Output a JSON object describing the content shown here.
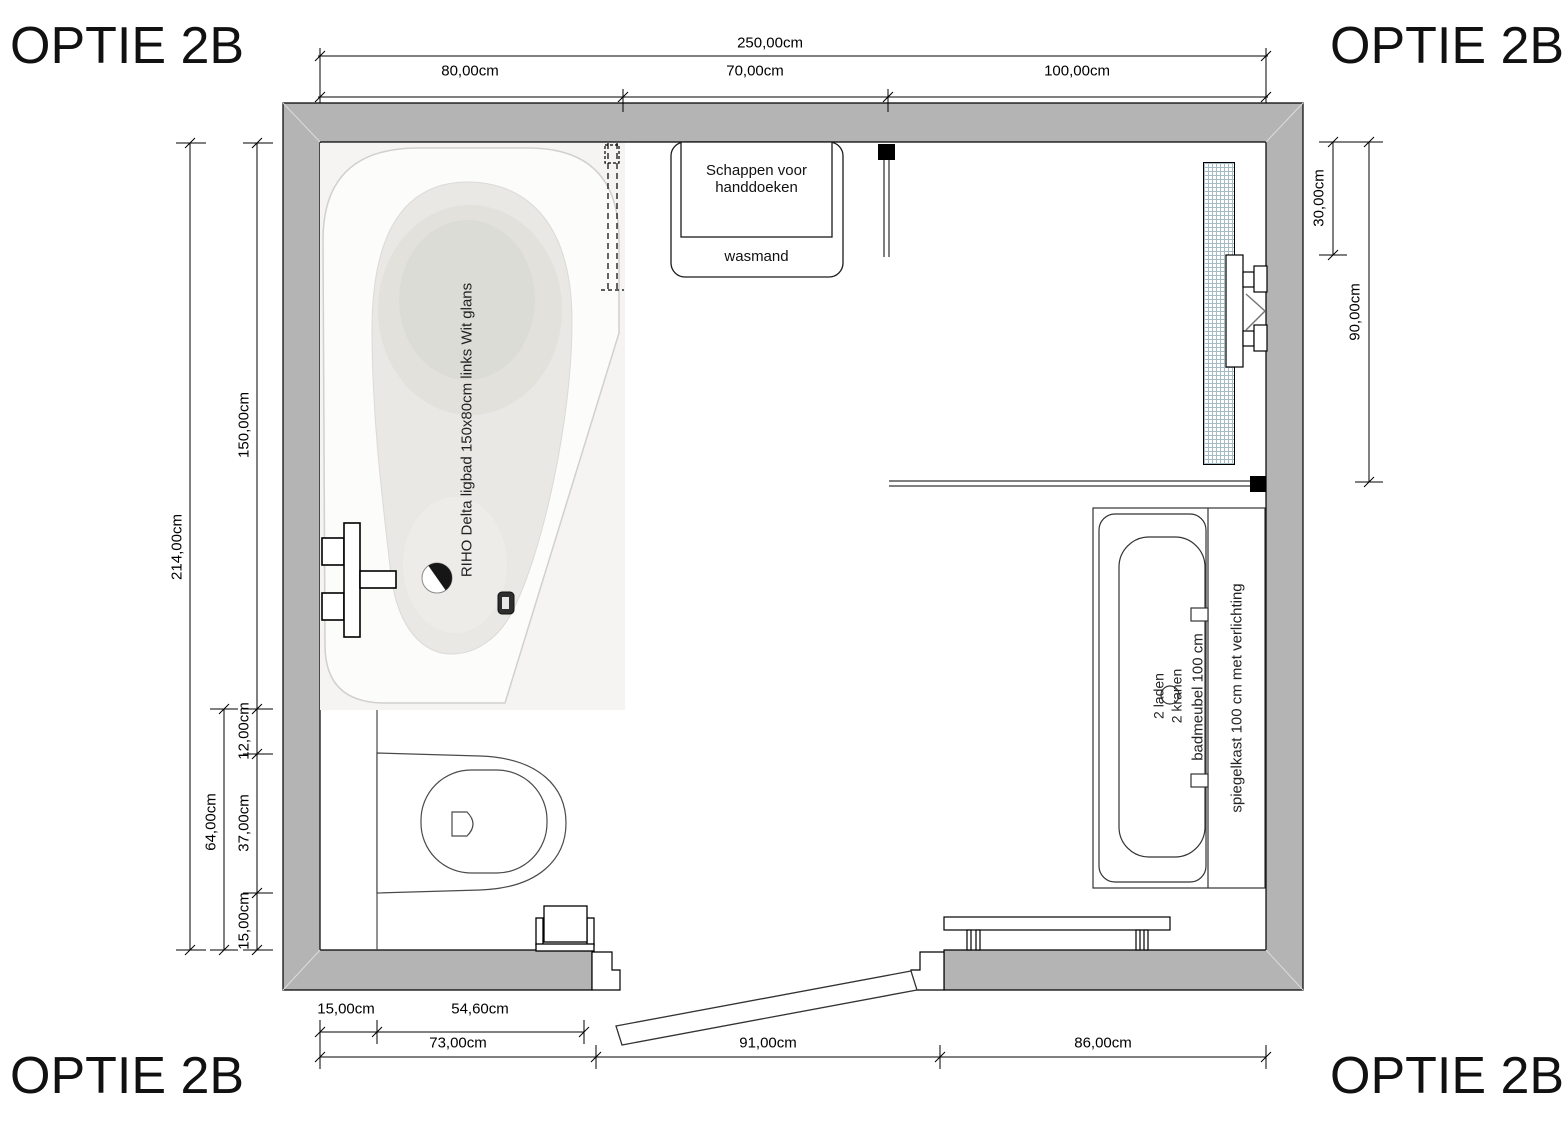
{
  "corner_label": "OPTIE 2B",
  "dimensions": {
    "total_width": "250,00cm",
    "top_bath_width": "80,00cm",
    "top_mid_width": "70,00cm",
    "top_right_width": "100,00cm",
    "left_total_height": "214,00cm",
    "left_bath_length": "150,00cm",
    "left_lower_total": "64,00cm",
    "left_gap": "12,00cm",
    "left_toilet": "37,00cm",
    "left_bottom_gap": "15,00cm",
    "right_glass_return": "30,00cm",
    "right_shower_depth": "90,00cm",
    "bottom_inset": "15,00cm",
    "bottom_niche": "54,60cm",
    "bottom_left_wall": "73,00cm",
    "bottom_door_opening": "91,00cm",
    "bottom_right_wall": "86,00cm"
  },
  "labels": {
    "bathtub": "RIHO Delta ligbad 150x80cm links Wit glans",
    "shelves": "Schappen voor handdoeken",
    "laundry_basket": "wasmand",
    "mirror_cabinet": "spiegelkast 100 cm met verlichting",
    "vanity": "badmeubel 100 cm",
    "vanity_drawers": "2 laden",
    "vanity_taps": "2 kranen"
  },
  "colors": {
    "wall_gray": "#b4b4b4",
    "radiator_grid": "#a5bcc6"
  }
}
